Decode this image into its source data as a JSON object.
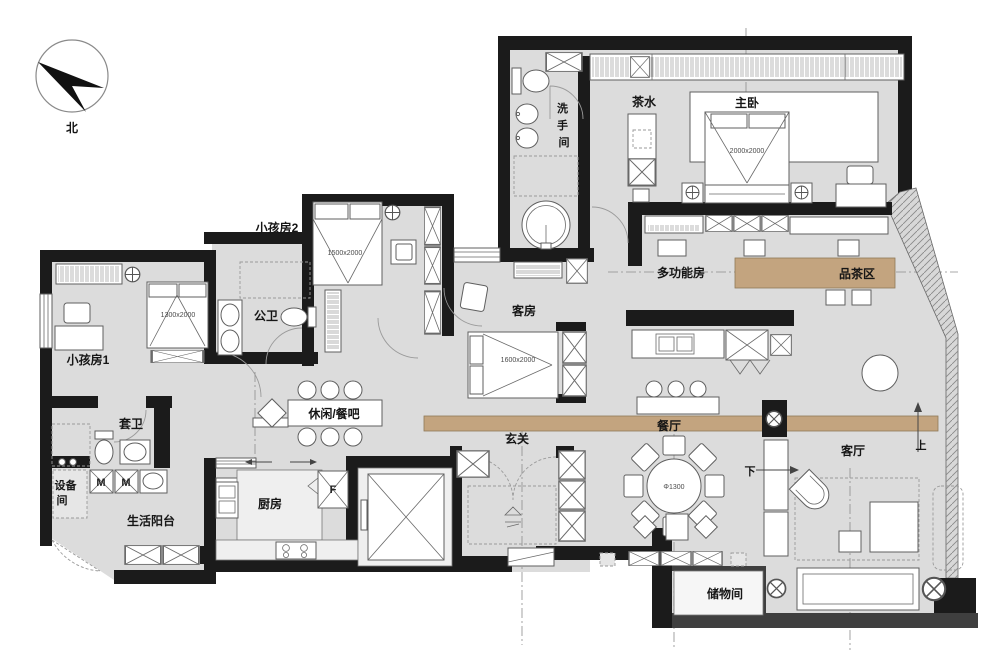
{
  "title": "apartment-floor-plan",
  "colors": {
    "floor": "#dcdcdc",
    "wall": "#1b1b1b",
    "accent_tan": "#c3a47f",
    "line": "#5f5f5f"
  },
  "compass": {
    "label": "北"
  },
  "rooms": {
    "washroom": {
      "label": "洗手间",
      "chars": [
        "洗",
        "手",
        "间"
      ]
    },
    "tea_station": {
      "label": "茶水"
    },
    "master_bedroom": {
      "label": "主卧",
      "bed_dim": "2000x2000"
    },
    "kids_room_2": {
      "label": "小孩房2",
      "bed_dim": "1500x2000"
    },
    "multi_function_room": {
      "label": "多功能房"
    },
    "tea_area": {
      "label": "品茶区"
    },
    "kids_room_1": {
      "label": "小孩房1",
      "bed_dim": "1300x2000"
    },
    "public_bath": {
      "label": "公卫"
    },
    "guest_room": {
      "label": "客房",
      "bed_dim": "1600x2000"
    },
    "leisure_bar": {
      "label": "休闲/餐吧"
    },
    "ensuite_bath": {
      "label": "套卫"
    },
    "equipment_room": {
      "label": "设备间",
      "chars": [
        "设备",
        "间"
      ]
    },
    "service_balcony": {
      "label": "生活阳台"
    },
    "kitchen": {
      "label": "厨房"
    },
    "foyer": {
      "label": "玄关"
    },
    "dining_room": {
      "label": "餐厅",
      "table_dim": "Φ1300"
    },
    "living_room": {
      "label": "客厅"
    },
    "storage": {
      "label": "储物间"
    }
  },
  "markers": {
    "fridge": "F",
    "washer": "M",
    "up": "上",
    "down": "下"
  }
}
